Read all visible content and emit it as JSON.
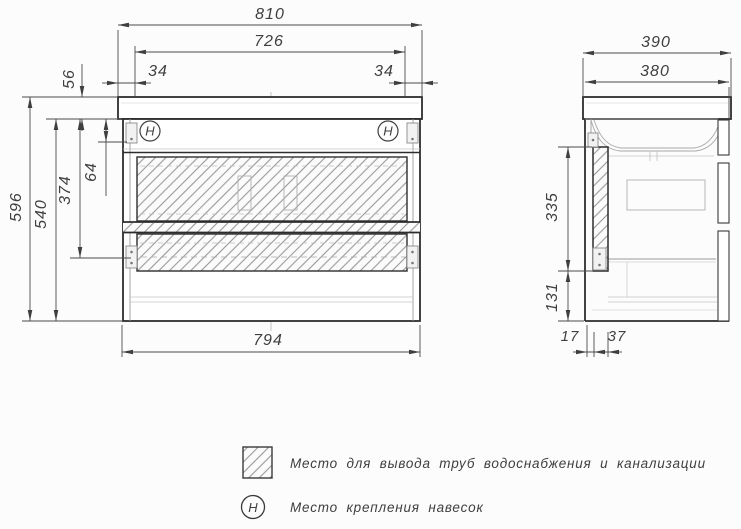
{
  "front_view": {
    "dims": {
      "total_width": "810",
      "basin_width": "726",
      "side_offset_left": "34",
      "side_offset_right": "34",
      "countertop_height": "56",
      "hanger_offset": "64",
      "hanger_span": "374",
      "overall_height": "596",
      "cabinet_height": "540",
      "cabinet_width": "794"
    },
    "hanger_mark": "H"
  },
  "side_view": {
    "dims": {
      "total_depth": "390",
      "cabinet_depth": "380",
      "pipe_zone_height": "335",
      "bottom_section_height": "131",
      "front_wall_offset": "17",
      "pipe_zone_depth": "37"
    }
  },
  "legend": {
    "items": [
      {
        "symbol": "hatched-square",
        "label": "Место для вывода труб водоснабжения и канализации"
      },
      {
        "symbol": "H",
        "label": "Место крепления навесок"
      }
    ]
  },
  "colors": {
    "heavy_line": "#2d2d2d",
    "dim_line": "#4a4a4a",
    "hatch_line": "#848484",
    "text": "#3f3f3f",
    "background": "#fcfcfc"
  }
}
